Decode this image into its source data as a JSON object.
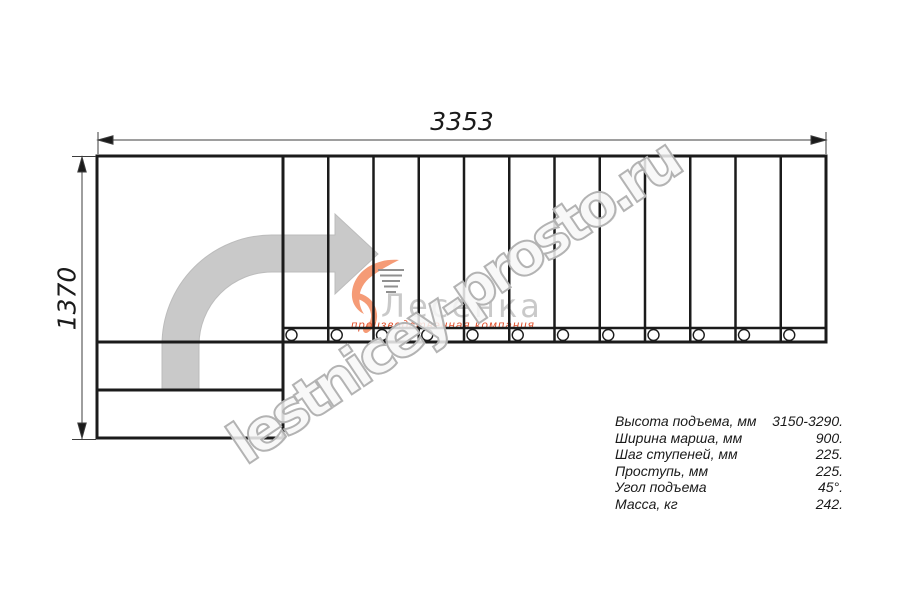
{
  "drawing": {
    "width_dim": {
      "label": "3353"
    },
    "height_dim": {
      "label": "1370"
    },
    "flight": {
      "treads": 12,
      "balusters": 12
    },
    "landing": {
      "rows_below": 2
    },
    "colors": {
      "line": "#1b1b1b",
      "dimension": "#3c3c3c",
      "direction_arrow": "#c9c9c9"
    }
  },
  "specs": {
    "rows": [
      {
        "label": "Высота подъема, мм",
        "value": "3150-3290."
      },
      {
        "label": "Ширина марша, мм",
        "value": "900."
      },
      {
        "label": "Шаг ступеней, мм",
        "value": "225."
      },
      {
        "label": "Проступь, мм",
        "value": "225."
      },
      {
        "label": "Угол подъема",
        "value": "45°."
      },
      {
        "label": "Масса, кг",
        "value": "242."
      }
    ]
  },
  "watermark": {
    "site": "lestnicey-prosto.ru",
    "brand_name": "Лесенка",
    "brand_tagline": "производственная компания",
    "accent_color": "#f59b76",
    "text_color": "#b3b3b3"
  }
}
